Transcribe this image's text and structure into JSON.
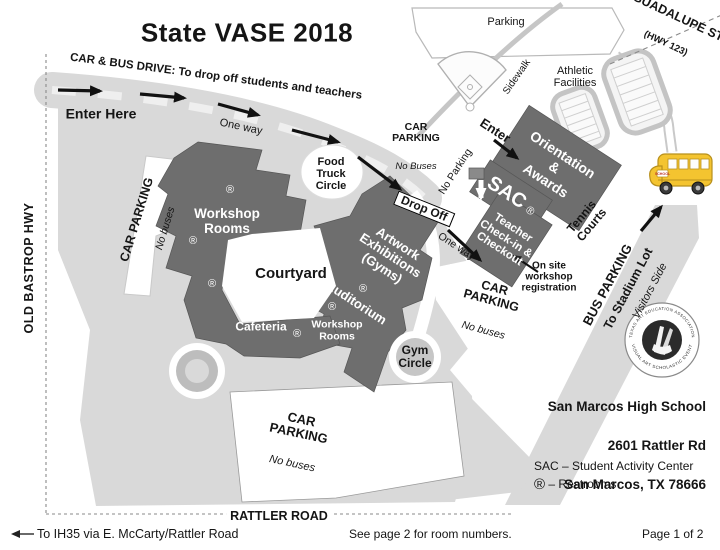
{
  "title": "State VASE 2018",
  "colors": {
    "building": "#6e6e6e",
    "road": "#d9d9d9",
    "bus_yellow": "#f4c430",
    "page": "#ffffff"
  },
  "symbols": {
    "restroom": "®"
  },
  "roads": {
    "guadalupe": "GUADALUPE ST",
    "guadalupe_hwy": "(HWY 123)",
    "old_bastrop": "OLD BASTROP HWY",
    "rattler": "RATTLER ROAD",
    "car_bus_drive": "CAR & BUS DRIVE: To drop off students and teachers",
    "sidewalk": "Sidewalk",
    "one_way": "One way",
    "no_parking": "No Parking",
    "drop_off": "Drop Off",
    "enter": "Enter",
    "enter_here": "Enter Here"
  },
  "areas": {
    "parking_top": "Parking",
    "athletic": "Athletic\nFacilities",
    "car_parking": "CAR PARKING",
    "car_parking_2line": "CAR\nPARKING",
    "no_buses": "No buses",
    "no_buses_cap": "No Buses",
    "food_truck": "Food\nTruck\nCircle",
    "gym_circle": "Gym\nCircle",
    "courtyard": "Courtyard",
    "tennis": "Tennis\nCourts",
    "bus_parking": "BUS PARKING",
    "to_stadium": "To Stadium Lot",
    "visitors": "Visitors Side",
    "onsite": "On site\nworkshop\nregistration"
  },
  "buildings": {
    "workshop_main": "Workshop\nRooms",
    "workshop_south": "Workshop\nRooms",
    "cafeteria": "Cafeteria",
    "auditorium": "Auditorium",
    "artwork": "Artwork\nExhibitions\n(Gyms)",
    "orientation": "Orientation\n&\nAwards",
    "sac": "SAC",
    "teacher": "Teacher\nCheck-in &\nCheckout"
  },
  "seal": {
    "top": "TEXAS ART EDUCATION ASSOCIATION",
    "bottom": "VISUAL ART SCHOLASTIC EVENT"
  },
  "address": {
    "line1": "San Marcos High School",
    "line2": "2601 Rattler Rd",
    "line3": "San Marcos, TX  78666"
  },
  "legend": {
    "sac": "SAC – Student Activity Center",
    "r_symbol": "®",
    "restrooms": "– Restrooms"
  },
  "footer": {
    "left": "To IH35 via E. McCarty/Rattler Road",
    "mid": "See page 2 for room numbers.",
    "right": "Page 1 of 2"
  },
  "bus_sign": "SCHOOL"
}
